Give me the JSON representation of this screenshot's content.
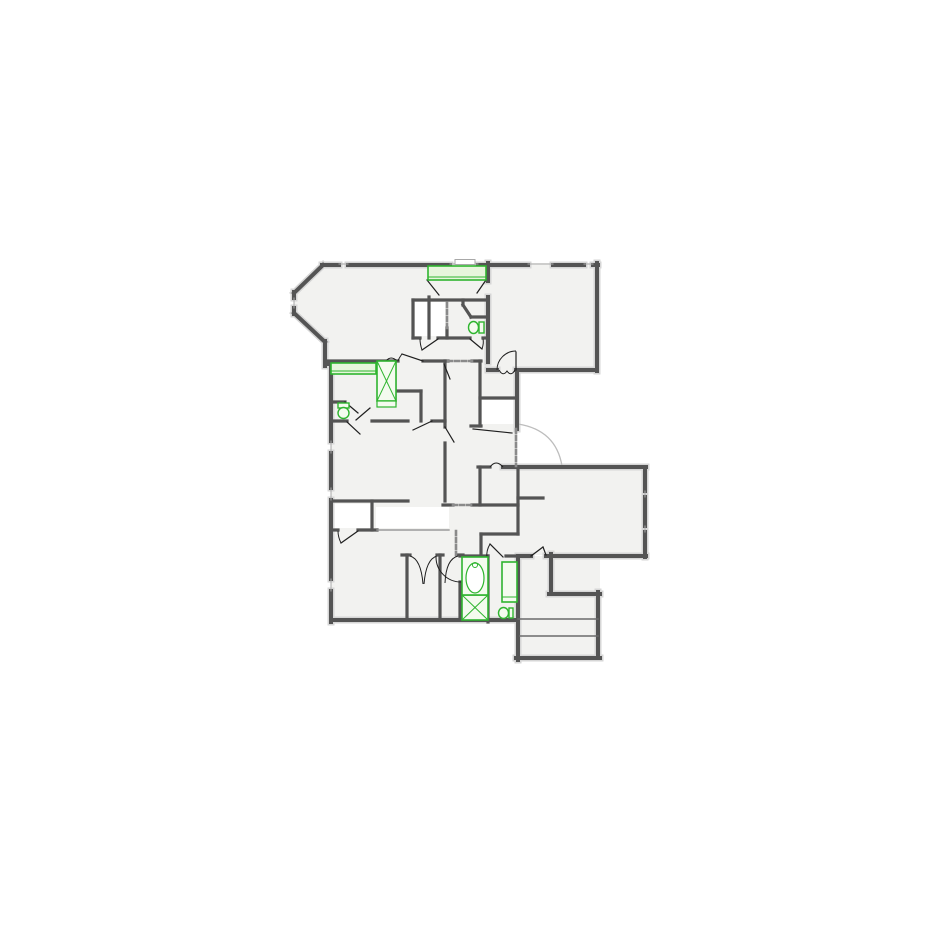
{
  "meta": {
    "canvas_w": 925,
    "canvas_h": 925,
    "background": "#ffffff",
    "floor_fill": "#f2f2f0",
    "white_fill": "#ffffff",
    "wall_color": "#545454",
    "wall_shadow": "#d6d6d6",
    "leaf_color": "#1f1f1f",
    "arc_color": "#bdbdbd",
    "dash_color": "#8a8a8a",
    "sill_color": "#a8a8a8",
    "thin_color": "#9a9a9a",
    "tread_color": "#6a6a6a",
    "green_stroke": "#2fb52f",
    "green_fill": "#e7f6dc",
    "green_fill_light": "#f4fbef"
  },
  "floor": {
    "polygons": [
      {
        "name": "great-room-and-top-right-room",
        "points": "322,263 597,263 597,370 517,370 517,467 480,467 480,361 325,361 325,342 294,313 294,292"
      }
    ],
    "rects": [
      {
        "name": "left-main-block",
        "x": 331,
        "y": 361,
        "w": 149,
        "h": 259
      },
      {
        "name": "center-bedroom-and-bath",
        "x": 480,
        "y": 467,
        "w": 38,
        "h": 155
      },
      {
        "name": "middle-right-room",
        "x": 518,
        "y": 467,
        "w": 127,
        "h": 88
      },
      {
        "name": "stairwell",
        "x": 518,
        "y": 556,
        "w": 82,
        "h": 102
      }
    ],
    "white_patches": [
      {
        "name": "closet-small",
        "x": 334,
        "y": 504,
        "w": 37,
        "h": 24
      },
      {
        "name": "lower-hall",
        "x": 376,
        "y": 507,
        "w": 73,
        "h": 21
      },
      {
        "name": "vestibule",
        "x": 482,
        "y": 400,
        "w": 34,
        "h": 24
      },
      {
        "name": "upper-closets",
        "x": 415,
        "y": 302,
        "w": 30,
        "h": 34
      }
    ],
    "window_bump": {
      "x": 455,
      "y": 259.5,
      "w": 20,
      "h": 5
    }
  },
  "walls": {
    "exterior": [
      [
        322,
        265,
        339,
        265
      ],
      [
        348,
        265,
        450,
        265
      ],
      [
        478,
        265,
        528,
        265
      ],
      [
        553,
        265,
        584,
        265
      ],
      [
        593,
        265,
        598,
        265
      ],
      [
        323,
        265,
        294,
        293
      ],
      [
        294,
        292,
        294,
        298
      ],
      [
        294,
        308,
        294,
        314
      ],
      [
        294,
        313,
        325,
        342
      ],
      [
        325,
        341,
        325,
        366
      ],
      [
        325,
        364,
        331,
        364
      ],
      [
        331,
        364,
        331,
        441
      ],
      [
        331,
        453,
        331,
        488
      ],
      [
        331,
        500,
        331,
        579
      ],
      [
        331,
        591,
        331,
        622
      ],
      [
        331,
        620,
        518,
        620
      ],
      [
        518,
        556,
        518,
        660
      ],
      [
        516,
        658,
        600,
        658
      ],
      [
        598,
        658,
        598,
        592
      ],
      [
        600,
        594,
        549,
        594
      ],
      [
        551,
        594,
        551,
        554
      ],
      [
        520,
        556,
        531,
        556
      ],
      [
        546,
        556,
        646,
        556
      ],
      [
        645,
        467,
        645,
        491
      ],
      [
        645,
        497,
        645,
        526
      ],
      [
        645,
        532,
        645,
        557
      ],
      [
        503,
        467,
        646,
        467
      ],
      [
        597,
        263,
        597,
        371
      ],
      [
        597,
        370,
        516,
        370
      ],
      [
        497,
        370,
        488,
        370
      ],
      [
        517,
        370,
        517,
        429
      ],
      [
        488,
        263,
        488,
        281
      ],
      [
        488,
        297,
        488,
        362
      ]
    ],
    "interior": [
      [
        325,
        361,
        398,
        361
      ],
      [
        423,
        361,
        448,
        361
      ],
      [
        472,
        361,
        481,
        361
      ],
      [
        413,
        300,
        488,
        300
      ],
      [
        413,
        300,
        413,
        338
      ],
      [
        429,
        297,
        429,
        338
      ],
      [
        447,
        328,
        447,
        338
      ],
      [
        413,
        338,
        420,
        338
      ],
      [
        438,
        338,
        470,
        338
      ],
      [
        483,
        338,
        488,
        338
      ],
      [
        463,
        300,
        463,
        305
      ],
      [
        463,
        305,
        471,
        317
      ],
      [
        471,
        317,
        488,
        317
      ],
      [
        395,
        361,
        395,
        403
      ],
      [
        395,
        391,
        421,
        391
      ],
      [
        421,
        391,
        421,
        421
      ],
      [
        331,
        402,
        345,
        402
      ],
      [
        331,
        421,
        347,
        421
      ],
      [
        372,
        421,
        408,
        421
      ],
      [
        432,
        421,
        445,
        421
      ],
      [
        445,
        361,
        445,
        427
      ],
      [
        445,
        443,
        445,
        501
      ],
      [
        480,
        361,
        480,
        426
      ],
      [
        471,
        426,
        481,
        426
      ],
      [
        480,
        467,
        480,
        505
      ],
      [
        478,
        467,
        490,
        467
      ],
      [
        480,
        398,
        517,
        398
      ],
      [
        331,
        501,
        408,
        501
      ],
      [
        443,
        505,
        453,
        505
      ],
      [
        472,
        505,
        518,
        505
      ],
      [
        372,
        501,
        372,
        530
      ],
      [
        331,
        530,
        338,
        530
      ],
      [
        358,
        530,
        377,
        530
      ],
      [
        518,
        467,
        518,
        534
      ],
      [
        518,
        498,
        543,
        498
      ],
      [
        481,
        534,
        518,
        534
      ],
      [
        481,
        534,
        481,
        557
      ],
      [
        402,
        555,
        410,
        555
      ],
      [
        437,
        555,
        443,
        555
      ],
      [
        458,
        555,
        463,
        555
      ],
      [
        460,
        556,
        488,
        556
      ],
      [
        506,
        556,
        520,
        556
      ],
      [
        460,
        582,
        460,
        620
      ],
      [
        407,
        555,
        407,
        620
      ],
      [
        440,
        555,
        440,
        620
      ],
      [
        488,
        556,
        488,
        622
      ]
    ],
    "treads": [
      [
        518,
        619,
        598,
        619
      ],
      [
        520,
        636,
        598,
        636
      ]
    ],
    "sills": [
      [
        339,
        264,
        348,
        264
      ],
      [
        450,
        264,
        478,
        264
      ],
      [
        528,
        264,
        553,
        264
      ],
      [
        584,
        264,
        593,
        264
      ],
      [
        331,
        441,
        331,
        453
      ],
      [
        331,
        488,
        331,
        500
      ],
      [
        331,
        579,
        331,
        591
      ],
      [
        294,
        298,
        294,
        308
      ],
      [
        645,
        491,
        645,
        497
      ],
      [
        645,
        526,
        645,
        532
      ]
    ],
    "thin": [
      [
        377,
        530,
        449,
        530
      ]
    ],
    "dashes": [
      [
        448,
        361,
        472,
        361
      ],
      [
        447,
        303,
        447,
        328
      ],
      [
        516,
        429,
        516,
        466
      ],
      [
        453,
        505,
        472,
        505
      ],
      [
        456,
        531,
        456,
        555
      ]
    ]
  },
  "doors": {
    "leaves": [
      [
        427,
        280,
        439,
        295
      ],
      [
        486,
        280,
        477,
        293
      ],
      [
        516,
        370,
        516,
        352
      ],
      [
        423,
        361,
        402,
        354
      ],
      [
        438,
        339,
        422,
        350
      ],
      [
        470,
        339,
        482,
        349
      ],
      [
        444,
        364,
        450,
        379
      ],
      [
        445,
        427,
        454,
        442
      ],
      [
        432,
        421,
        413,
        430
      ],
      [
        345,
        402,
        358,
        413
      ],
      [
        356,
        420,
        370,
        408
      ],
      [
        347,
        422,
        360,
        434
      ],
      [
        358,
        531,
        341,
        543
      ],
      [
        473,
        429,
        512,
        433
      ],
      [
        503,
        557,
        490,
        544
      ],
      [
        531,
        556,
        543,
        547
      ],
      [
        543,
        547,
        546,
        555
      ]
    ],
    "arcs": [
      "M497,370 A19,19 0 0 1 516,351",
      "M402,354 Q399,358 398,361",
      "M422,350 Q420,344 420,339",
      "M482,349 Q484,343 483,339",
      "M341,543 Q338,537 338,531",
      "M490,544 Q486,551 487,557",
      "M436,557 A25,25 0 0 0 461,582",
      "M410,556 Q421,559 423,584",
      "M437,556 Q426,559 424,584",
      "M458,556 Q446,559 445,583"
    ],
    "bumps": [
      "M499,370 Q503,377 507,371 Q511,377 515,370",
      "M386,361 Q391,355 397,361",
      "M490,467 Q496,459 503,467"
    ],
    "swing_arc_large": "M518,424 Q556,430 562,466"
  },
  "fixtures": {
    "counters": [
      {
        "name": "kitchen-counter-top",
        "x": 428,
        "y": 266,
        "w": 58,
        "h": 14,
        "inner": [
          429,
          277,
          485,
          277
        ]
      },
      {
        "name": "counter-left",
        "x": 331,
        "y": 363,
        "w": 45,
        "h": 11,
        "inner": [
          332,
          371,
          375,
          371
        ]
      }
    ],
    "xboxes": [
      {
        "name": "linen-cabinet-upper",
        "x": 377,
        "y": 361,
        "w": 19,
        "h": 40,
        "base": {
          "x": 377,
          "y": 401,
          "w": 19,
          "h": 6
        }
      },
      {
        "name": "linen-cabinet-bath",
        "x": 462,
        "y": 595,
        "w": 26,
        "h": 25
      }
    ],
    "tub": {
      "x": 462,
      "y": 557,
      "w": 26,
      "h": 38,
      "ellipse": {
        "cx": 475,
        "cy": 578,
        "rx": 9,
        "ry": 15
      },
      "faucet": {
        "cx": 475,
        "cy": 565,
        "r": 2.5
      }
    },
    "cabinet": {
      "x": 502,
      "y": 562,
      "w": 15,
      "h": 40,
      "inner": [
        502,
        597,
        517,
        597
      ]
    },
    "toilets": [
      {
        "name": "toilet-upper-bath",
        "tank": {
          "x": 479,
          "y": 322,
          "w": 5,
          "h": 11
        },
        "bowl": {
          "cx": 473.5,
          "cy": 327.5,
          "rx": 5,
          "ry": 6
        }
      },
      {
        "name": "toilet-left-bath",
        "tank": {
          "x": 338,
          "y": 403,
          "w": 11,
          "h": 5
        },
        "bowl": {
          "cx": 343.5,
          "cy": 413,
          "rx": 5.5,
          "ry": 5.5
        }
      },
      {
        "name": "toilet-lower-bath",
        "tank": {
          "x": 509,
          "y": 608,
          "w": 4,
          "h": 10
        },
        "bowl": {
          "cx": 503.5,
          "cy": 613,
          "rx": 5,
          "ry": 5.5
        }
      }
    ]
  }
}
